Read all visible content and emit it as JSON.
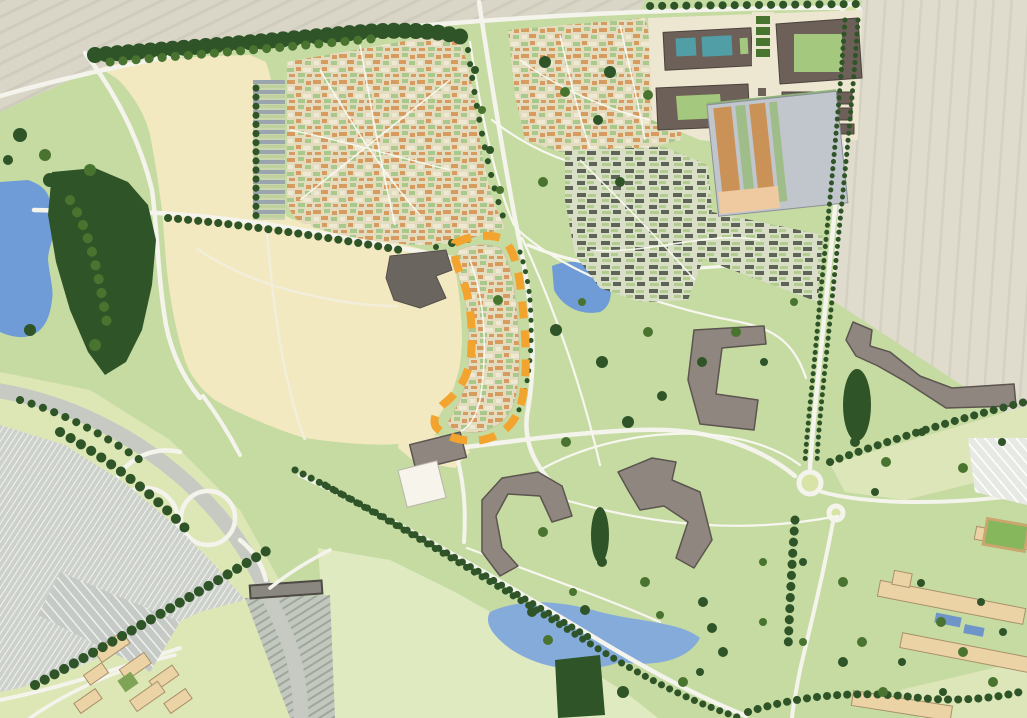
{
  "meta": {
    "aria_label": "Illustrative masterplan aerial site plan showing housing neighbourhoods, parkland, ponds, tree-lined avenues, a motorway junction with park-and-ride, and an orange dashed boundary around a crescent-shaped housing parcel"
  },
  "colors": {
    "base": "#C6DBA2",
    "fieldA": "#D9D6C8",
    "fieldALine": "#CFCCBE",
    "fieldB": "#DFDCCE",
    "fieldBLine": "#D4D1C2",
    "paleField": "#E0EAC0",
    "paleField2": "#DCE6B8",
    "swGreen": "#DDE7B6",
    "cream": "#F2E9C1",
    "road": "#F4F4EC",
    "pathc": "#F7F7EF",
    "highway": "#C7C9C3",
    "hatchBase": "#C2C8BD",
    "hatchLine": "#9FA69B",
    "bridge": "#8A8680",
    "bridgeEdge": "#4E4A45",
    "treeDark": "#2F5428",
    "treeMid": "#49742F",
    "treeLight": "#5E8A36",
    "water": "#6F9CD6",
    "waterLight": "#85ABDB",
    "teal": "#519EA6",
    "blockGray": "#8F867F",
    "blockGrayEdge": "#5C554F",
    "blockBrown": "#6C6058",
    "blockBrownEdge": "#4A423C",
    "plaza": "#EDE7D2",
    "resBase": "#E4DCBE",
    "roofOrange": "#D79B60",
    "roofPale": "#EFE8D2",
    "garden": "#A9C88C",
    "resDarkBase": "#D9DEC6",
    "roofDark": "#5E6358",
    "gardenLight": "#B2CC90",
    "terraceBase": "#CBD6B0",
    "terraceRoof": "#9AA5AE",
    "terraceGreen": "#BFD19C",
    "stripeBase": "#C1C6CC",
    "stripeOrange": "#CB9258",
    "stripeGreen": "#9FBD88",
    "peach": "#EFC9A0",
    "parkingBase": "#CDD1CC",
    "parkingLine": "#F2F2EE",
    "rowsBase": "#C6CAC6",
    "rowsLight": "#E7E9E4",
    "tan": "#ECD3A6",
    "tanEdge": "#A8906A",
    "glass": "#6E94C8",
    "dashOrange": "#F2A42F",
    "schoolDark": "#6B655F",
    "white": "#F7F4EC",
    "allotGreen": "#86B75C",
    "courtGreen": "#A4C87E",
    "rounder": "#D8E3A6"
  },
  "features": [
    "farmland-fields",
    "woodland-belts",
    "western-pond",
    "ornamental-lake",
    "southern-pond",
    "courtyard-pools",
    "street-network",
    "tree-lined-avenues",
    "motorway-junction",
    "park-and-ride-car-park",
    "northwest-housing-neighbourhood",
    "northeast-housing-neighbourhood",
    "eastern-terraced-housing",
    "crescent-housing-parcel",
    "site-boundary-highlight",
    "town-centre-blocks",
    "market-garden-building",
    "school-building",
    "apartment-blocks",
    "business-campus-southwest",
    "campus-southeast",
    "allotments",
    "central-parkland",
    "roundabouts"
  ]
}
